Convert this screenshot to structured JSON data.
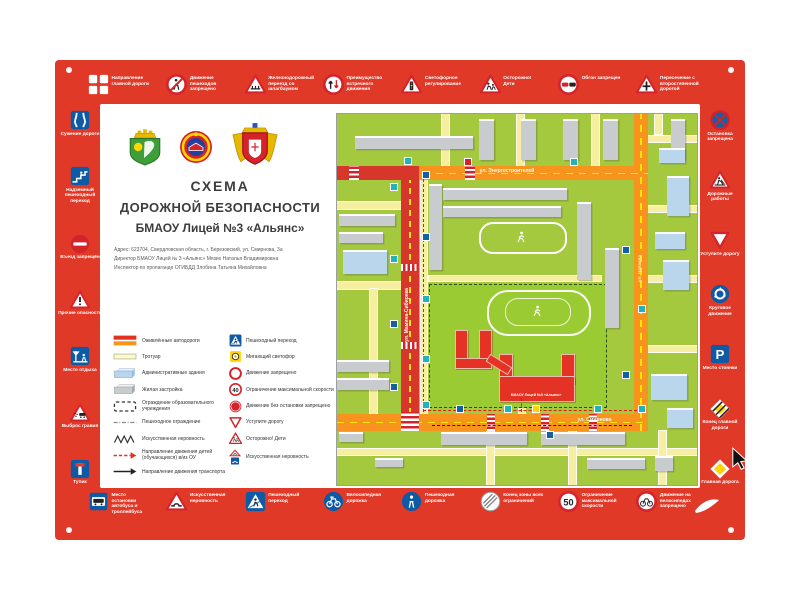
{
  "poster": {
    "bg_color": "#e13928",
    "title_line1": "СХЕМА",
    "title_line2": "ДОРОЖНОЙ  БЕЗОПАСНОСТИ",
    "title_line3": "БМАОУ Лицей №3 «Альянс»",
    "address_lines": [
      "Адрес: 623704, Свердловская область, г. Березовский, ул. Смирнова, 3а",
      "Директор БМАОУ Лицей № 3 «Альянс» Мязих Наталья Владимировна",
      "Инспектор по пропаганде ОГИБДД Злобина Татьяна Михайловна"
    ],
    "emblems": [
      "coat-of-arms-berezovsky",
      "gibdd-emblem",
      "coat-of-arms-sverdlovsk-oblast"
    ]
  },
  "signs": {
    "top": [
      {
        "icon": "main-road-direction",
        "label": "Направление главной дороги"
      },
      {
        "icon": "no-pedestrians",
        "label": "Движение пешеходов запрещено"
      },
      {
        "icon": "railway-crossing",
        "label": "Железнодорожный переезд со шлагбаумом"
      },
      {
        "icon": "oncoming-priority",
        "label": "Преимущество встречного движения"
      },
      {
        "icon": "traffic-light",
        "label": "Светофорное регулирование"
      },
      {
        "icon": "children",
        "label": "Осторожно! Дети"
      },
      {
        "icon": "no-overtaking",
        "label": "Обгон запрещен"
      },
      {
        "icon": "secondary-road",
        "label": "Пересечение с второстепенной дорогой"
      }
    ],
    "left": [
      {
        "icon": "road-narrows",
        "label": "Сужение дороги"
      },
      {
        "icon": "overpass",
        "label": "Надземный пешеходный переход"
      },
      {
        "icon": "no-entry",
        "label": "Въезд запрещён"
      },
      {
        "icon": "other-danger",
        "label": "Прочие опасности"
      },
      {
        "icon": "rest-place",
        "label": "Место отдыха"
      },
      {
        "icon": "gravel",
        "label": "Выброс гравия"
      },
      {
        "icon": "dead-end",
        "label": "Тупик"
      }
    ],
    "right": [
      {
        "icon": "no-stopping",
        "label": "Остановка запрещена"
      },
      {
        "icon": "road-works",
        "label": "Дорожные работы"
      },
      {
        "icon": "give-way",
        "label": "Уступите дорогу"
      },
      {
        "icon": "roundabout",
        "label": "Круговое движение"
      },
      {
        "icon": "parking",
        "label": "Место стоянки"
      },
      {
        "icon": "end-main-road",
        "label": "Конец главной дороги"
      },
      {
        "icon": "main-road",
        "label": "Главная дорога"
      }
    ],
    "bottom": [
      {
        "icon": "bus-stop",
        "label": "Место остановки автобуса и троллейбуса"
      },
      {
        "icon": "speed-bump",
        "label": "Искусственная неровность"
      },
      {
        "icon": "ped-crossing",
        "label": "Пешеходный переход"
      },
      {
        "icon": "bike-path",
        "label": "Велосипедная дорожка"
      },
      {
        "icon": "ped-path",
        "label": "Пешеходная дорожка"
      },
      {
        "icon": "end-restrictions",
        "label": "Конец зоны всех ограничений"
      },
      {
        "icon": "speed-50",
        "label": "Ограничение максимальной скорости"
      },
      {
        "icon": "no-bikes",
        "label": "Движение на велосипедах запрещено"
      }
    ]
  },
  "legend": {
    "left": [
      {
        "icon": "busy-roads",
        "label": "Оживлённые автодороги"
      },
      {
        "icon": "sidewalk",
        "label": "Тротуар"
      },
      {
        "icon": "admin-building",
        "label": "Административные здания"
      },
      {
        "icon": "residential",
        "label": "Жилая застройка"
      },
      {
        "icon": "school-fence",
        "label": "Ограждение образовательного учреждения"
      },
      {
        "icon": "ped-fence",
        "label": "Пешеходное ограждение"
      },
      {
        "icon": "hump-zigzag",
        "label": "Искусственная неровность"
      },
      {
        "icon": "children-route",
        "label": "Направление движения детей (обучающихся) в/из ОУ"
      },
      {
        "icon": "transport-route",
        "label": "Направление движения транспорта"
      }
    ],
    "right": [
      {
        "icon": "ped-crossing",
        "label": "Пешеходный переход"
      },
      {
        "icon": "flashing-signal",
        "label": "Мигающий светофор"
      },
      {
        "icon": "no-move",
        "label": "Движение запрещено"
      },
      {
        "icon": "limit-40",
        "label": "Ограничение максимальной скорости"
      },
      {
        "icon": "no-stop-move",
        "label": "Движение без остановки запрещено"
      },
      {
        "icon": "give-way",
        "label": "Уступите дорогу"
      },
      {
        "icon": "children",
        "label": "Осторожно! Дети"
      },
      {
        "icon": "hump-sign",
        "label": "Искусственная неровность"
      }
    ]
  },
  "map": {
    "streets": [
      {
        "name": "ул. Энергостроителей",
        "orientation": "horizontal"
      },
      {
        "name": "ул. Мамина-Сибиряка",
        "orientation": "vertical"
      },
      {
        "name": "ул. Смирнова",
        "orientation": "horizontal"
      },
      {
        "name": "ул. Чапаева",
        "orientation": "vertical"
      }
    ],
    "school_label": "БМАОУ Лицей №3 «Альянс»",
    "colors": {
      "ground": "#a4c83e",
      "school_zone": "#9bcb32",
      "major_road": "#f7941e",
      "busy_road": "#d7372a",
      "minor_road": "#f6efa2",
      "school_building": "#e43225",
      "residential_building": "#c9ccce",
      "administrative_building": "#b9d6ec"
    }
  }
}
